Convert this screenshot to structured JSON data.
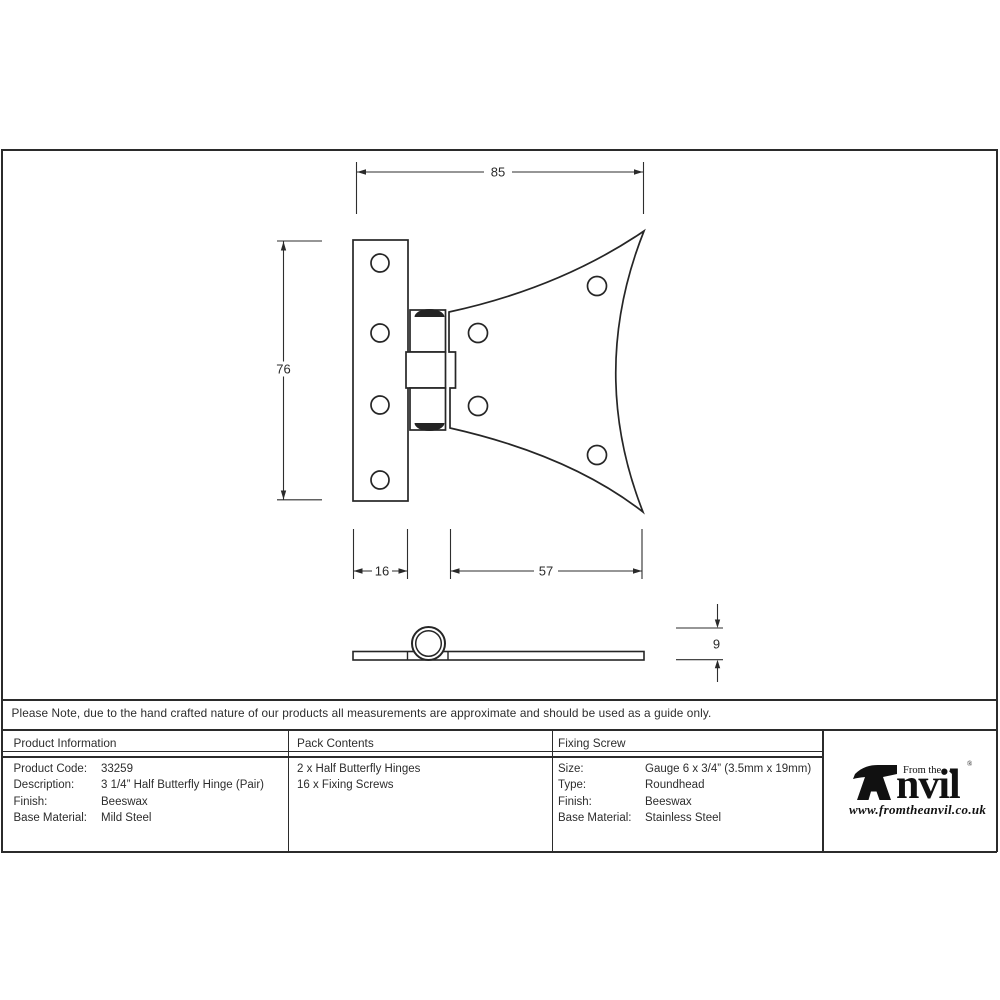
{
  "sheet": {
    "note": "Please Note, due to the hand crafted nature of our products all measurements are approximate and should be used as a guide only."
  },
  "drawing": {
    "dim_width": "85",
    "dim_height": "76",
    "dim_leaf_width": "16",
    "dim_wing_width": "57",
    "dim_thickness": "9"
  },
  "table": {
    "product_info": {
      "header": "Product Information",
      "rows": [
        {
          "label": "Product Code:",
          "value": "33259"
        },
        {
          "label": "Description:",
          "value": "3 1/4” Half Butterfly Hinge (Pair)"
        },
        {
          "label": "Finish:",
          "value": "Beeswax"
        },
        {
          "label": "Base Material:",
          "value": "Mild Steel"
        }
      ]
    },
    "pack_contents": {
      "header": "Pack Contents",
      "items": [
        "2 x Half Butterfly Hinges",
        "16 x Fixing Screws"
      ]
    },
    "fixing_screw": {
      "header": "Fixing Screw",
      "rows": [
        {
          "label": "Size:",
          "value": "Gauge 6 x 3/4” (3.5mm x 19mm)"
        },
        {
          "label": "Type:",
          "value": "Roundhead"
        },
        {
          "label": "Finish:",
          "value": "Beeswax"
        },
        {
          "label": "Base Material:",
          "value": "Stainless Steel"
        }
      ]
    }
  },
  "logo": {
    "prefix": "From the",
    "diamond": "◆",
    "name_rest": "nvil",
    "registered": "®",
    "url": "www.fromtheanvil.co.uk"
  }
}
